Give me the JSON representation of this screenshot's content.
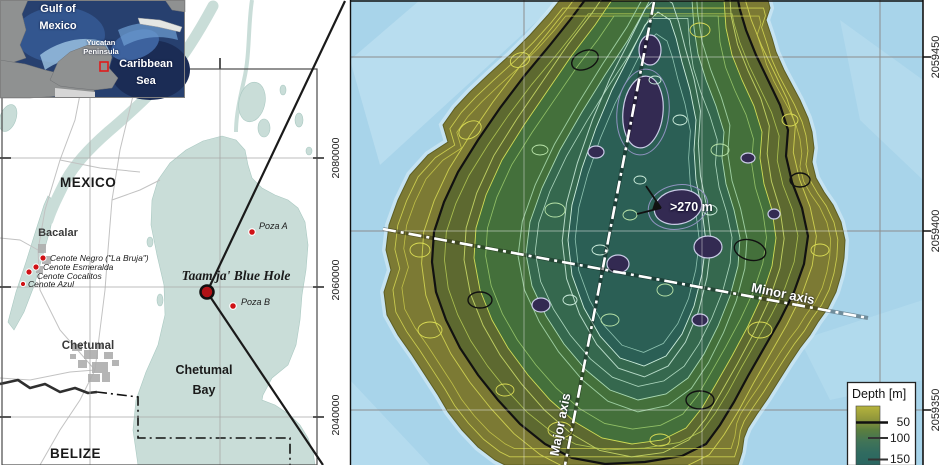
{
  "inset": {
    "labels": {
      "gulf_line1": "Gulf of",
      "gulf_line2": "Mexico",
      "yucatan_line1": "Yucatan",
      "yucatan_line2": "Peninsula",
      "caribbean_line1": "Caribbean",
      "caribbean_line2": "Sea"
    }
  },
  "left_map": {
    "country_labels": {
      "mexico": "MEXICO",
      "belize": "BELIZE"
    },
    "city_labels": {
      "bacalar": "Bacalar",
      "chetumal": "Chetumal"
    },
    "bay_label": {
      "line1": "Chetumal",
      "line2": "Bay"
    },
    "blue_hole_label": "Taam ja' Blue Hole",
    "cenotes": [
      {
        "label": "Cenote Negro (\"La Bruja\")"
      },
      {
        "label": "Cenote Esmeralda"
      },
      {
        "label": "Cenote Cocalitos"
      },
      {
        "label": "Cenote Azul"
      }
    ],
    "pozas": [
      {
        "label": "Poza A"
      },
      {
        "label": "Poza B"
      }
    ],
    "y_axis_ticks": [
      "2080000",
      "2060000",
      "2040000"
    ]
  },
  "right_map": {
    "y_axis_ticks": [
      "2059450",
      "2059400",
      "2059350"
    ],
    "depth_annotation": ">270 m",
    "major_axis_label": "Major axis",
    "minor_axis_label": "Minor axis",
    "legend": {
      "title": "Depth [m]",
      "ticks": [
        "50",
        "100",
        "150"
      ]
    },
    "colors": {
      "water": "#a8d4ea",
      "shallow_rim": "#7c7a34",
      "mid_green": "#44703b",
      "deep_teal": "#2b5f55",
      "deepest_purple": "#332a52",
      "marker_red": "#b01216"
    }
  }
}
